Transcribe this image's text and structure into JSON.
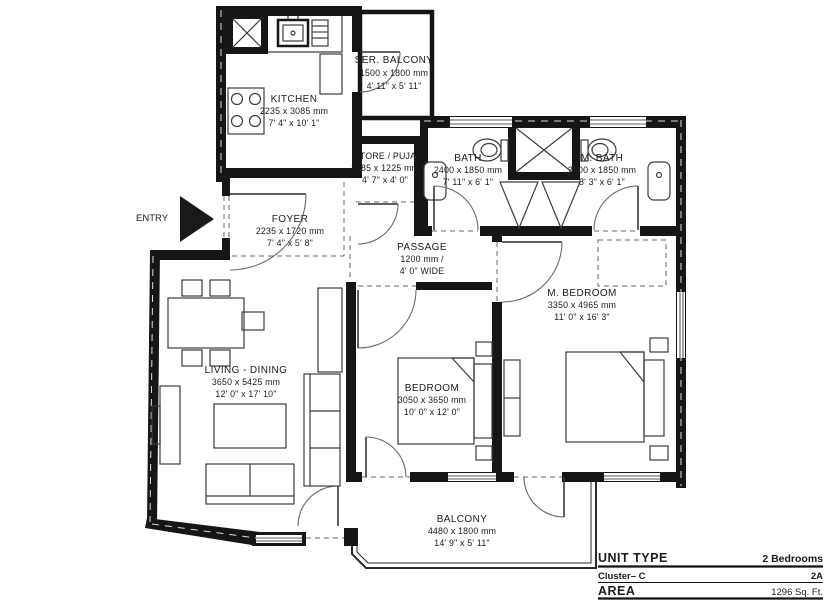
{
  "rooms": {
    "ser_balcony": {
      "name": "SER. BALCONY",
      "mm": "1500 x 1800 mm",
      "ft": "4' 11\" x 5' 11\""
    },
    "kitchen": {
      "name": "KITCHEN",
      "mm": "2235 x 3085 mm",
      "ft": "7' 4\" x 10' 1\""
    },
    "store": {
      "name": "STORE / PUJA",
      "mm": "1385 x 1225 mm",
      "ft": "4' 7\" x 4' 0\""
    },
    "bath": {
      "name": "BATH",
      "mm": "2400 x 1850 mm",
      "ft": "7' 11\" x 6' 1\""
    },
    "m_bath": {
      "name": "M. BATH",
      "mm": "2500 x 1850 mm",
      "ft": "8' 3\" x 6' 1\""
    },
    "foyer": {
      "name": "FOYER",
      "mm": "2235 x 1720 mm",
      "ft": "7' 4\" x 5' 8\""
    },
    "passage": {
      "name": "PASSAGE",
      "mm": "1200 mm /",
      "ft": "4' 0\" WIDE"
    },
    "living": {
      "name": "LIVING - DINING",
      "mm": "3650 x 5425 mm",
      "ft": "12' 0\" x 17' 10\""
    },
    "bedroom": {
      "name": "BEDROOM",
      "mm": "3050 x 3650 mm",
      "ft": "10' 0\" x 12' 0\""
    },
    "m_bedroom": {
      "name": "M. BEDROOM",
      "mm": "3350 x 4965 mm",
      "ft": "11' 0\" x 16' 3\""
    },
    "balcony": {
      "name": "BALCONY",
      "mm": "4480 x 1800 mm",
      "ft": "14' 9\" x 5' 11\""
    }
  },
  "entry_label": "ENTRY",
  "title_block": {
    "unit_type_label": "UNIT TYPE",
    "unit_type_value": "2 Bedrooms",
    "cluster_label": "Cluster– C",
    "cluster_value": "2A",
    "area_label": "AREA",
    "area_value": "1296 Sq. Ft."
  },
  "colors": {
    "wall": "#161616",
    "furniture_line": "#3c3c3c",
    "background": "#ffffff"
  }
}
